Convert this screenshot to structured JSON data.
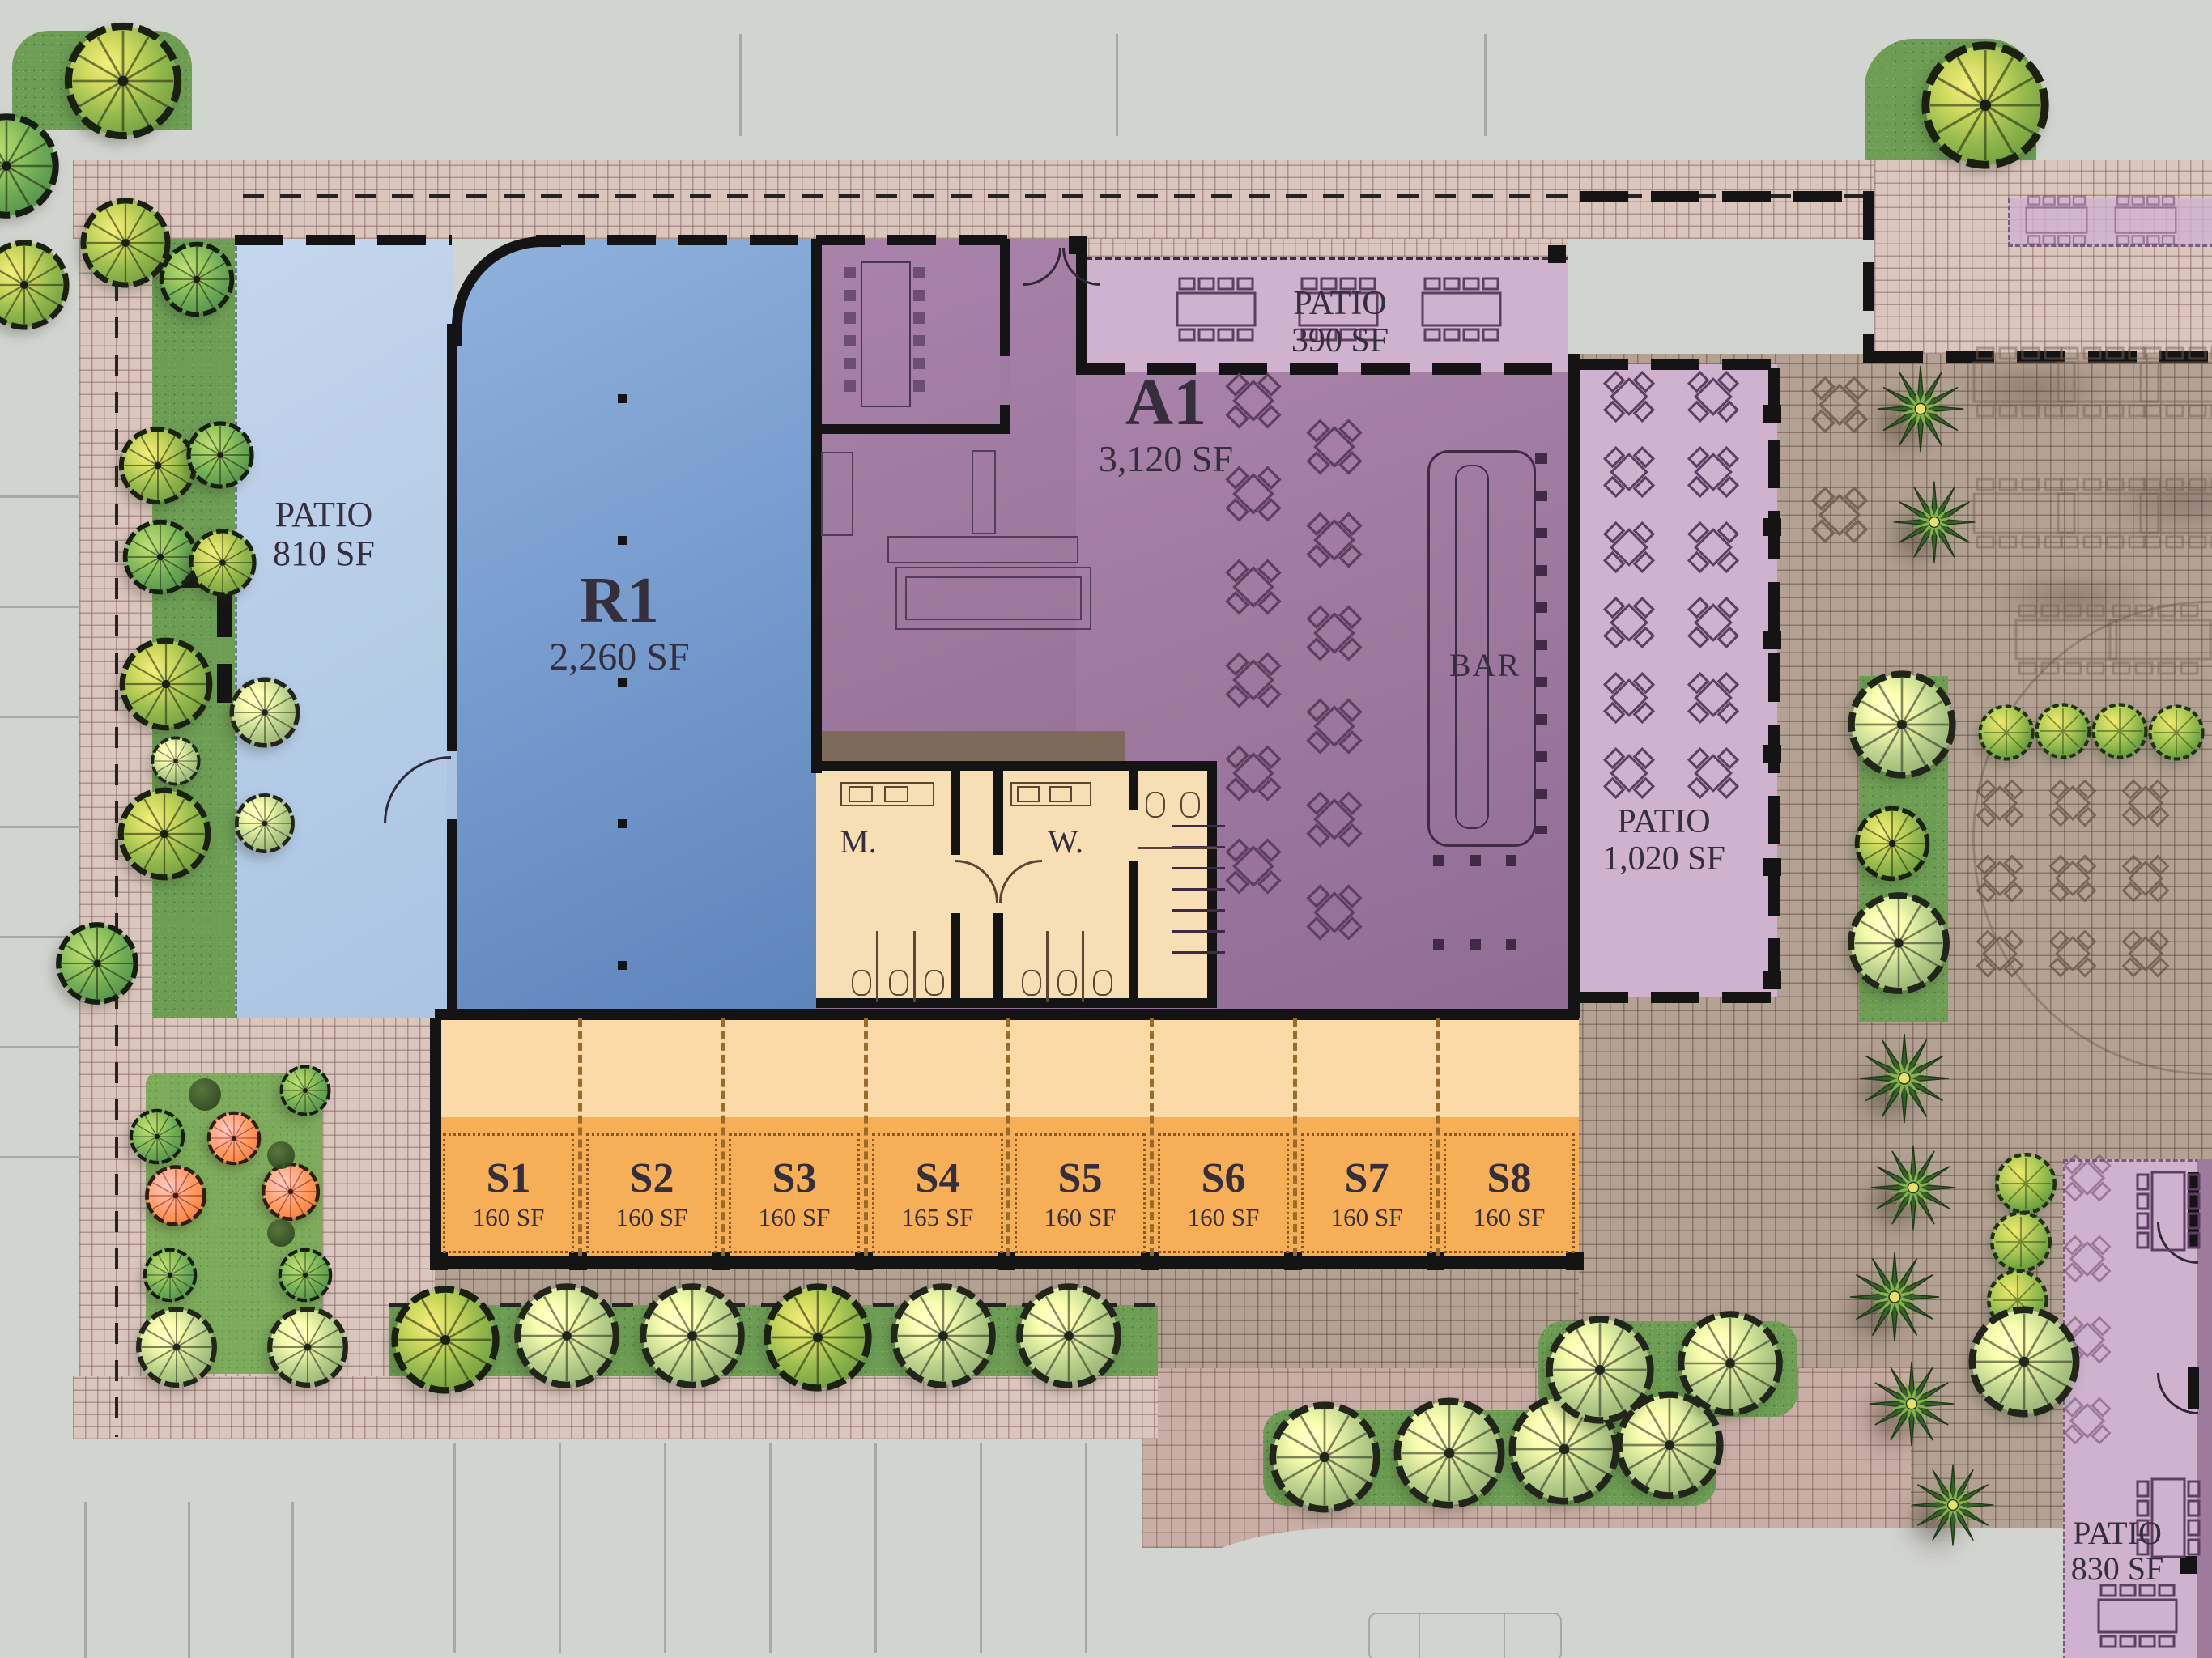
{
  "site": {
    "labels": {
      "patio810": {
        "title": "PATIO",
        "area": "810 SF"
      },
      "r1": {
        "title": "R1",
        "area": "2,260 SF"
      },
      "a1": {
        "title": "A1",
        "area": "3,120 SF"
      },
      "patio390": {
        "title": "PATIO",
        "area": "390 SF"
      },
      "patio1020": {
        "title": "PATIO",
        "area": "1,020 SF"
      },
      "patio830": {
        "title": "PATIO",
        "area": "830 SF"
      },
      "bar": "BAR",
      "mens": "M.",
      "womens": "W."
    },
    "stalls": [
      {
        "name": "S1",
        "area": "160 SF"
      },
      {
        "name": "S2",
        "area": "160 SF"
      },
      {
        "name": "S3",
        "area": "160 SF"
      },
      {
        "name": "S4",
        "area": "165 SF"
      },
      {
        "name": "S5",
        "area": "160 SF"
      },
      {
        "name": "S6",
        "area": "160 SF"
      },
      {
        "name": "S7",
        "area": "160 SF"
      },
      {
        "name": "S8",
        "area": "160 SF"
      }
    ],
    "colors": {
      "r1_blue": "#6f95c8",
      "patio_blue": "#b9cfe7",
      "a1_purple": "#a07da0",
      "patio_lavender": "#cfb2ce",
      "stall_orange": "#f6ae57",
      "corridor_peach": "#fbdaa8",
      "restroom_cream": "#f7dfb5",
      "service_brown": "#7d6a5b",
      "wall_black": "#141414",
      "brick_walk": "#dbc6be",
      "plaza_brick": "#b3a294",
      "grass_green": "#6d9e54"
    },
    "icons": {
      "tree": "deciduous-tree-icon",
      "palm": "palm-tree-icon",
      "bush": "shrub-icon",
      "table_square": "square-table-with-chairs-icon",
      "table_rect": "rect-table-with-chairs-icon"
    }
  }
}
